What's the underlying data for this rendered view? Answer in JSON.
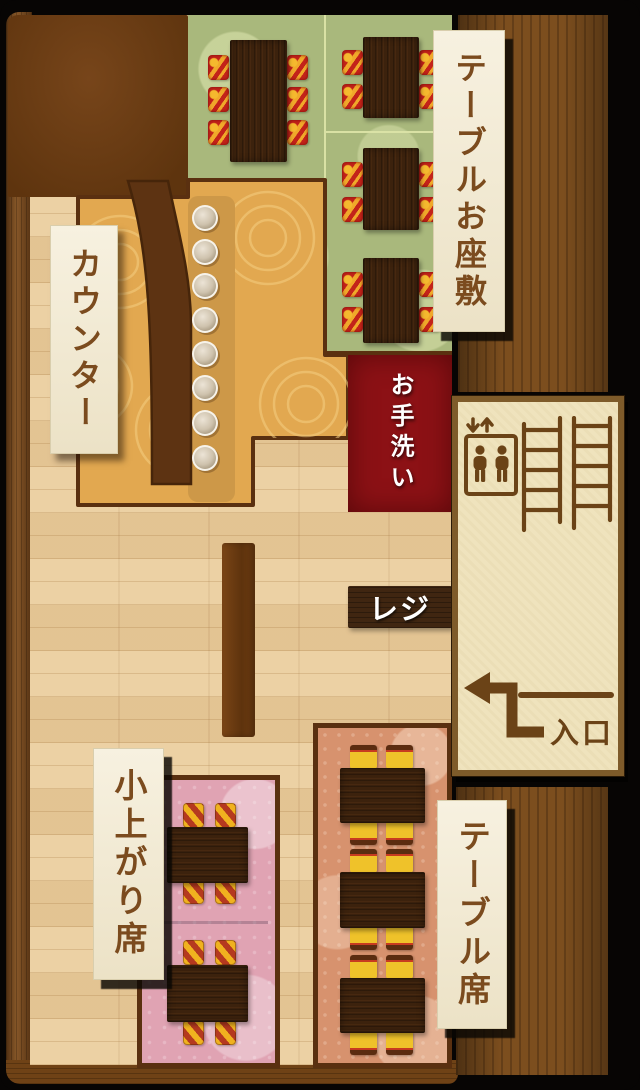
{
  "floor_map": {
    "tatami_room": {
      "label": "テーブルお座敷",
      "table_count": 4,
      "floor_color": "#a9b87c"
    },
    "counter": {
      "label": "カウンター",
      "stool_count": 8,
      "floor_color": "#e2a850"
    },
    "restroom": {
      "label": "お手洗い",
      "color": "#8c1115"
    },
    "register": {
      "label": "レジ"
    },
    "entrance": {
      "label": "入口",
      "icons": [
        "elevator-icon",
        "stairs-icon",
        "entry-path-arrow"
      ]
    },
    "koagari": {
      "label": "小上がり席",
      "table_count": 2,
      "floor_color": "#e0a3b3"
    },
    "table_seats": {
      "label": "テーブル席",
      "table_count": 3,
      "floor_color": "#d7926e"
    }
  }
}
